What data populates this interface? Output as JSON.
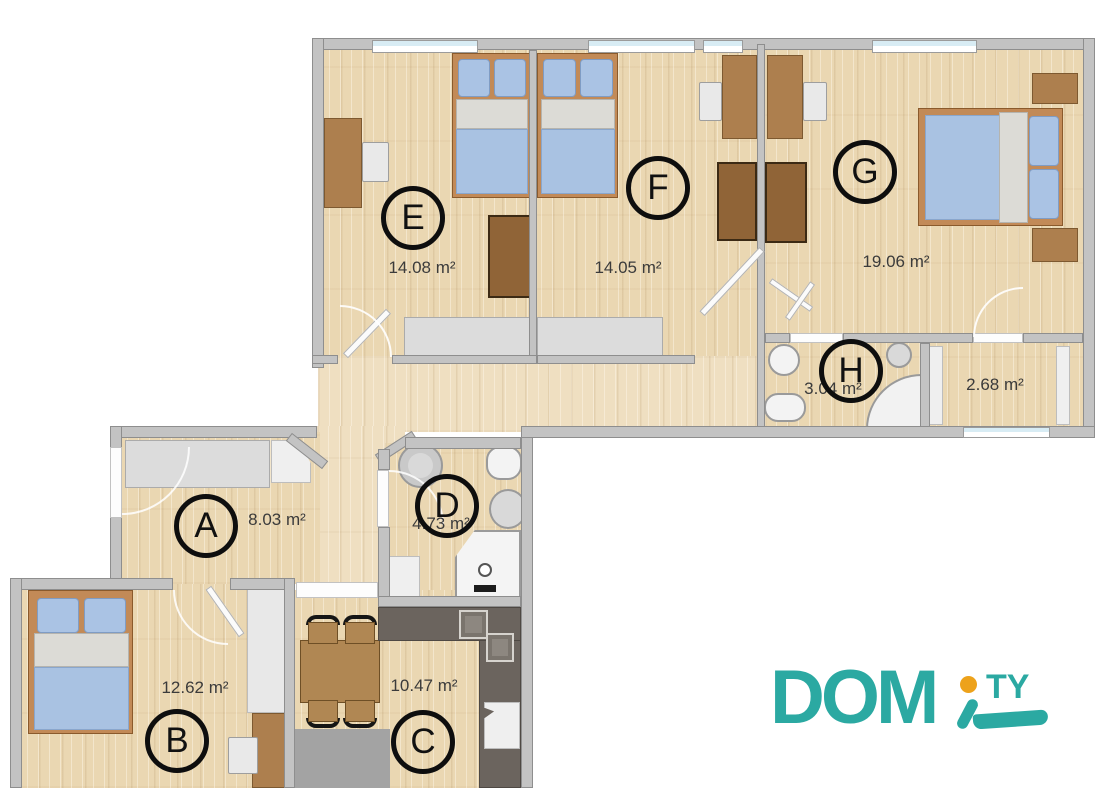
{
  "brand": {
    "name_main": "DOM",
    "name_dot": "i",
    "name_suffix": "TY",
    "color_teal": "#2BA9A2",
    "color_orange": "#EDA21B"
  },
  "rooms": [
    {
      "key": "E",
      "label": "E",
      "area": "14.08 m²",
      "type": "bedroom"
    },
    {
      "key": "F",
      "label": "F",
      "area": "14.05 m²",
      "type": "bedroom"
    },
    {
      "key": "G",
      "label": "G",
      "area": "19.06 m²",
      "type": "bedroom"
    },
    {
      "key": "H",
      "label": "H",
      "area": "3.04 m²",
      "type": "bathroom"
    },
    {
      "key": "closet",
      "label": "",
      "area": "2.68 m²",
      "type": "closet"
    },
    {
      "key": "A",
      "label": "A",
      "area": "8.03 m²",
      "type": "hallway"
    },
    {
      "key": "D",
      "label": "D",
      "area": "4.73 m²",
      "type": "bathroom"
    },
    {
      "key": "B",
      "label": "B",
      "area": "12.62 m²",
      "type": "bedroom"
    },
    {
      "key": "C",
      "label": "C",
      "area": "10.47 m²",
      "type": "kitchen"
    }
  ],
  "palette": {
    "floor": "#EAD7B2",
    "wall": "#C3C3C3",
    "window_glass": "#D8ECF4",
    "kitchen_counter": "#6B645E",
    "bed_frame": "#C28A57",
    "textile_blue": "#A9C2E2",
    "furniture_wood": "#AD7F4E"
  }
}
